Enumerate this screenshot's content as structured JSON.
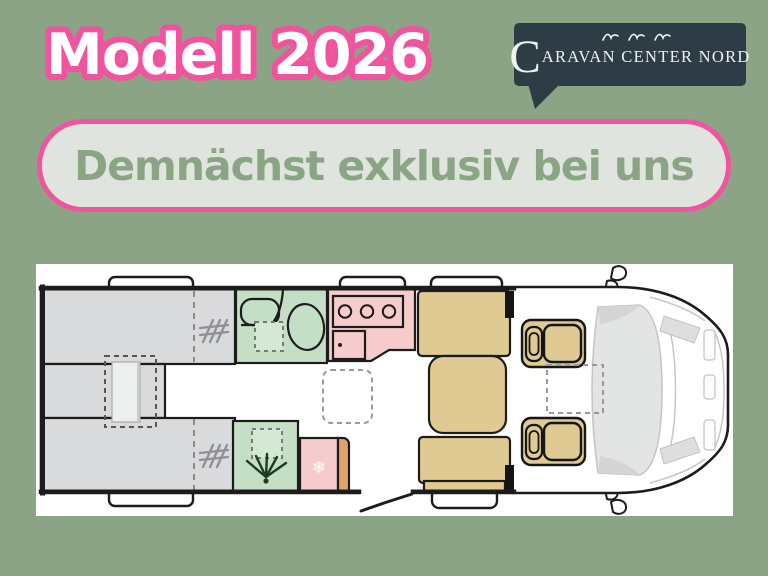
{
  "page": {
    "bg_color": "#8BA486"
  },
  "title": {
    "text": "Modell 2026",
    "fill_color": "#FFFFFF",
    "outline_color": "#F0549E"
  },
  "logo": {
    "initial": "C",
    "rest": "ARAVAN CENTER NORD",
    "full_name": "CARAVAN CENTER NORD",
    "bg_color": "#2E3D45",
    "text_color": "#EFF2EF",
    "birds_icon": "three-seagulls"
  },
  "banner": {
    "text": "Demnächst exklusiv bei uns",
    "fill_color": "#DFE4DE",
    "border_color": "#F0549E",
    "text_color": "#8AA584"
  },
  "floorplan": {
    "panel_bg": "#FFFFFF",
    "outline_color": "#1C1C1C",
    "areas": {
      "rear_beds": {
        "label": "twin-single-beds-with-wardrobes",
        "color": "#D9DADB"
      },
      "bathroom": {
        "label": "washroom-toilet-and-sink",
        "color": "#C5DFC6"
      },
      "shower": {
        "label": "shower-cubicle",
        "color": "#C5DFC6"
      },
      "kitchen": {
        "label": "kitchen-hob-and-sink",
        "color": "#F6CBCB"
      },
      "fridge": {
        "label": "fridge",
        "color": "#F6CBCB",
        "accent_color": "#E2A368"
      },
      "dinette": {
        "label": "dinette-benches-and-table",
        "color": "#DECA92"
      },
      "cab_seats": {
        "label": "swivel-cab-seats",
        "color": "#DECA92"
      },
      "cab_front": {
        "label": "driver-cab-windshield",
        "color": "#E3E4E4"
      }
    },
    "icons": {
      "snowflake": "❄"
    }
  }
}
